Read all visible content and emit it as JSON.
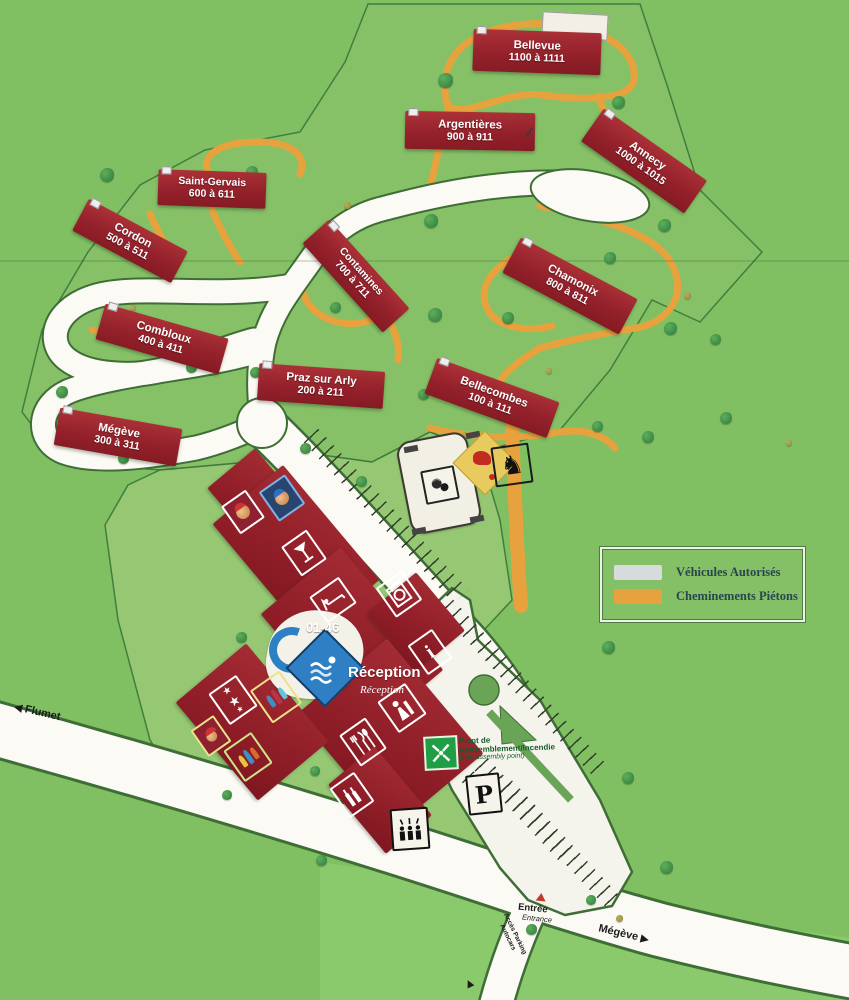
{
  "legend": {
    "items": [
      {
        "label": "Véhicules Autorisés",
        "color": "#d7dbde"
      },
      {
        "label": "Cheminements Piétons",
        "color": "#e7a23e"
      }
    ]
  },
  "buildings": [
    {
      "name": "Bellevue",
      "range": "1100 à 1111"
    },
    {
      "name": "Argentières",
      "range": "900 à 911"
    },
    {
      "name": "Annecy",
      "range": "1000 à 1015"
    },
    {
      "name": "Saint-Gervais",
      "range": "600 à 611"
    },
    {
      "name": "Cordon",
      "range": "500 à 511"
    },
    {
      "name": "Contamines",
      "range": "700 à 711"
    },
    {
      "name": "Chamonix",
      "range": "800 à 811"
    },
    {
      "name": "Combloux",
      "range": "400 à 411"
    },
    {
      "name": "Praz sur Arly",
      "range": "200 à 211"
    },
    {
      "name": "Bellecombes",
      "range": "100 à 111"
    },
    {
      "name": "Mégève",
      "range": "300 à 311"
    }
  ],
  "main_building": {
    "rooms": "01-46",
    "reception": "Réception",
    "reception_sub": "Réception"
  },
  "road_labels": {
    "flumet": "Flumet",
    "megeve": "Mégève",
    "entree": "Entrée",
    "entrance_sub": "Entrance",
    "access_parking": "Accès Parking Autocars"
  },
  "markers": {
    "parking": "P",
    "assembly_line1": "Point de",
    "assembly_line2": "Rassemblement/Incendie",
    "assembly_line3": "(Fire assembly point)"
  },
  "glyphs": {
    "star": "★",
    "horse": "♞",
    "info": "i",
    "arrow_left": "◀",
    "arrow_right": "▶",
    "check": "✓"
  },
  "icon_names": [
    "kids-club",
    "junior-club",
    "bar",
    "accommodation",
    "laundry",
    "information",
    "reception-desk",
    "restaurant",
    "cellar-bar",
    "evening-show",
    "entertainment",
    "mini-club",
    "swimming-pool",
    "petanque",
    "pony-club",
    "bus-stop",
    "fire-assembly-point",
    "parking"
  ]
}
